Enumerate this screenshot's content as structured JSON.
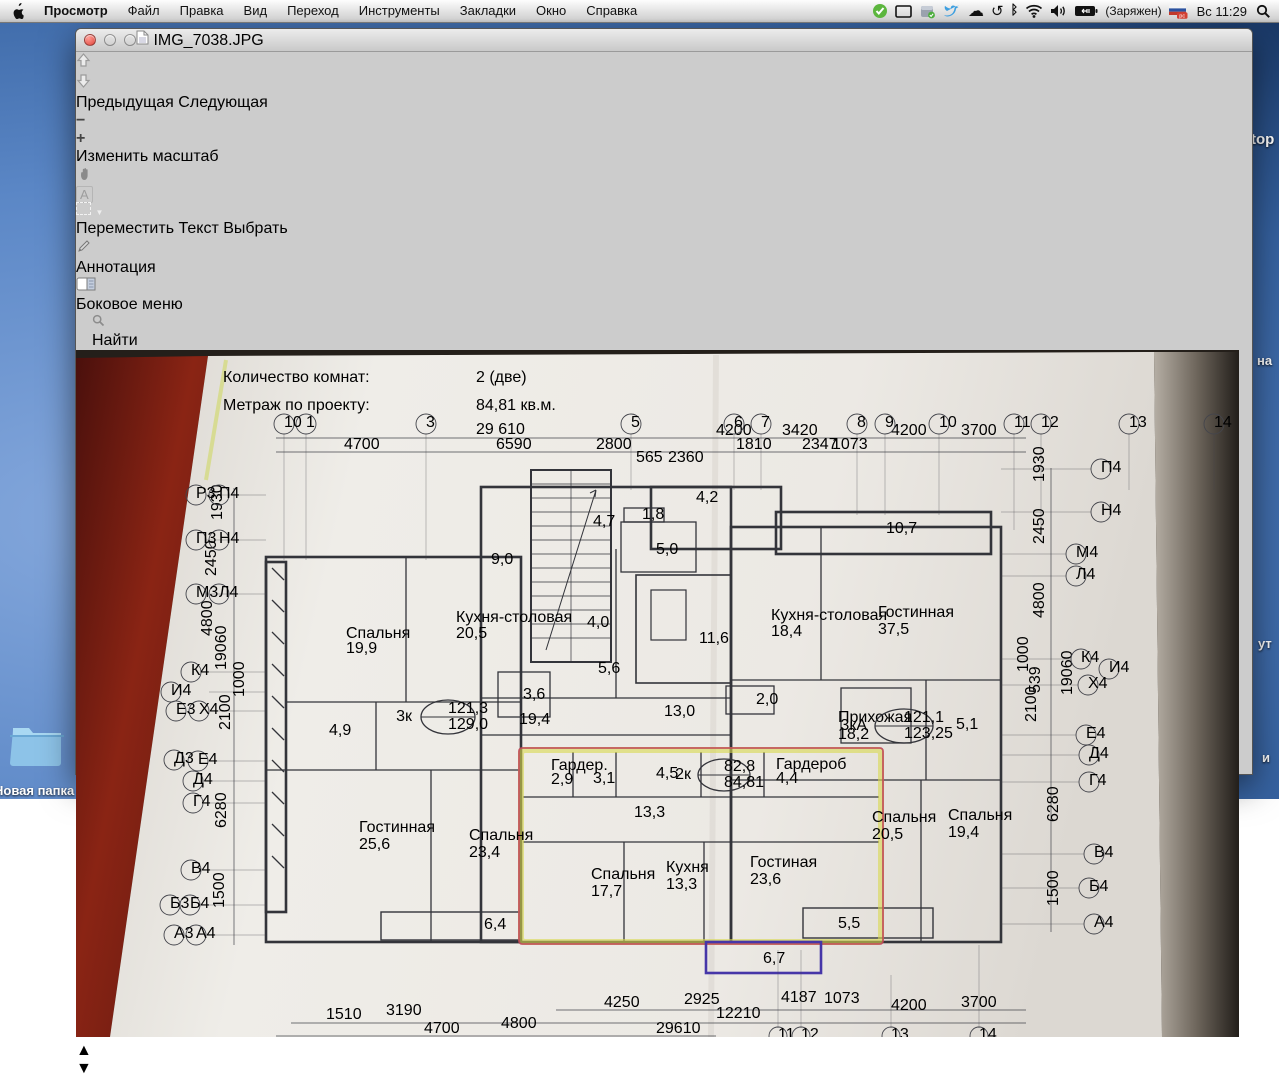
{
  "menu_bar": {
    "app_menu": "Просмотр",
    "items": [
      "Файл",
      "Правка",
      "Вид",
      "Переход",
      "Инструменты",
      "Закладки",
      "Окно",
      "Справка"
    ],
    "battery_label": "(Заряжен)",
    "flag_label": "рс",
    "clock": "Вс 11:29"
  },
  "window": {
    "title": "IMG_7038.JPG",
    "toolbar": {
      "previous": "Предыдущая",
      "next": "Следующая",
      "zoom": "Изменить масштаб",
      "move": "Переместить",
      "text": "Текст",
      "select": "Выбрать",
      "annotate": "Аннотация",
      "sidebar": "Боковое меню",
      "find": "Найти"
    }
  },
  "plan": {
    "header": {
      "rooms_label": "Количество комнат:",
      "rooms_value": "2 (две)",
      "area_label": "Метраж по проекту:",
      "area_value": "84,81 кв.м."
    },
    "units": [
      {
        "type": "3к",
        "living": "121,3",
        "total": "129,0"
      },
      {
        "type": "3кА",
        "living": "121,1",
        "total": "123,25"
      },
      {
        "type": "2к",
        "living": "82,8",
        "total": "84,81"
      }
    ],
    "rooms": [
      {
        "name": "Спальня",
        "area": "19,9"
      },
      {
        "name": "Кухня-столовая",
        "area": "20,5"
      },
      {
        "name": "Гостинная",
        "area": "25,6"
      },
      {
        "name": "Спальня",
        "area": "23,4"
      },
      {
        "name": "",
        "area": "4,9"
      },
      {
        "name": "",
        "area": "3,6"
      },
      {
        "name": "",
        "area": "19,4"
      },
      {
        "name": "",
        "area": "9,0"
      },
      {
        "name": "",
        "area": "6,4"
      },
      {
        "name": "",
        "area": "4,7"
      },
      {
        "name": "",
        "area": "1,8"
      },
      {
        "name": "",
        "area": "5,0"
      },
      {
        "name": "",
        "area": "4,2"
      },
      {
        "name": "",
        "area": "4,0"
      },
      {
        "name": "",
        "area": "5,6"
      },
      {
        "name": "",
        "area": "11,6"
      },
      {
        "name": "",
        "area": "13,0"
      },
      {
        "name": "",
        "area": "2,0"
      },
      {
        "name": "Кухня-столовая",
        "area": "18,4"
      },
      {
        "name": "Гостинная",
        "area": "37,5"
      },
      {
        "name": "",
        "area": "10,7"
      },
      {
        "name": "Прихожая",
        "area": "18,2"
      },
      {
        "name": "",
        "area": "5,1"
      },
      {
        "name": "Спальня",
        "area": "20,5"
      },
      {
        "name": "Спальня",
        "area": "19,4"
      },
      {
        "name": "",
        "area": "5,5"
      },
      {
        "name": "Гардер.",
        "area": "2,9"
      },
      {
        "name": "",
        "area": "3,1"
      },
      {
        "name": "",
        "area": "4,5"
      },
      {
        "name": "Гардероб",
        "area": "4,4"
      },
      {
        "name": "",
        "area": "13,3"
      },
      {
        "name": "Спальня",
        "area": "17,7"
      },
      {
        "name": "Кухня",
        "area": "13,3"
      },
      {
        "name": "Гостиная",
        "area": "23,6"
      },
      {
        "name": "",
        "area": "6,7"
      }
    ],
    "top_axis": [
      "10",
      "1",
      "3",
      "5",
      "6",
      "7",
      "8",
      "9",
      "10",
      "11",
      "12",
      "13",
      "14"
    ],
    "bottom_axis": [
      "11",
      "12",
      "13",
      "14"
    ],
    "left_axis": [
      "Р3",
      "П4",
      "П3",
      "Н4",
      "М3",
      "Л4",
      "К4",
      "И4",
      "Е3",
      "Х4",
      "Д3",
      "Е4",
      "Д4",
      "Г4",
      "В4",
      "Б3",
      "Б4",
      "А3",
      "А4"
    ],
    "right_axis": [
      "П4",
      "Н4",
      "М4",
      "Л4",
      "К4",
      "И4",
      "Х4",
      "Е4",
      "Д4",
      "Г4",
      "В4",
      "Б4",
      "А4"
    ],
    "top_dims": [
      "29 610",
      "4700",
      "6590",
      "2800",
      "565",
      "2360",
      "4200",
      "1810",
      "3420",
      "2347",
      "1073",
      "4200",
      "3700"
    ],
    "bottom_dims": [
      "1510",
      "3190",
      "4700",
      "4800",
      "4250",
      "2925",
      "12210",
      "29610",
      "4187",
      "1073",
      "4200",
      "3700"
    ],
    "left_dims": [
      "1930",
      "2450",
      "4800",
      "19060",
      "1000",
      "2100",
      "6280",
      "1500"
    ],
    "right_dims": [
      "1930",
      "2450",
      "4800",
      "1000",
      "539",
      "19060",
      "2100",
      "6280",
      "1500"
    ]
  },
  "desktop": {
    "folder_label": "Новая папка 2",
    "label_top": "top",
    "label_na": "на",
    "label_ut": "ут",
    "label_i": "и",
    "label_kartoch": "карточ...енная",
    "label_voi": "на вои...дый д"
  }
}
